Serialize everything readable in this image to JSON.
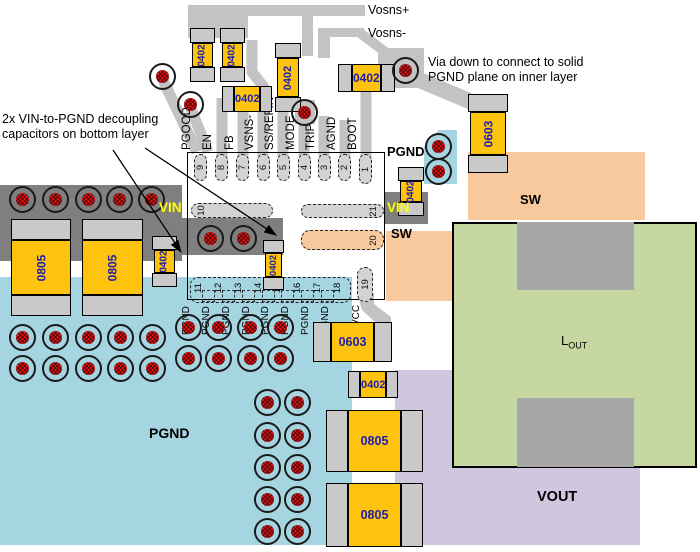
{
  "annotations": {
    "vosns_plus": "Vosns+",
    "vosns_minus": "Vosns-",
    "via_note_line1": "Via down to connect to solid",
    "via_note_line2": "PGND plane on inner layer",
    "decap_note_line1": "2x VIN-to-PGND decoupling",
    "decap_note_line2": "capacitors on bottom layer"
  },
  "planes": {
    "vin_left_label": "VIN",
    "vin_right_label": "VIN",
    "pgnd_patch_label": "PGND",
    "pgnd_main_label": "PGND",
    "sw_pin_label": "SW",
    "sw_plane_label": "SW",
    "vout_label": "VOUT",
    "lout_label_main": "L",
    "lout_label_sub": "OUT"
  },
  "ic": {
    "top_pins": [
      {
        "num": "9",
        "label": "PGOOD"
      },
      {
        "num": "8",
        "label": "EN"
      },
      {
        "num": "7",
        "label": "FB"
      },
      {
        "num": "6",
        "label": "VSNS-"
      },
      {
        "num": "5",
        "label": "SS/REFIN"
      },
      {
        "num": "4",
        "label": "MODE"
      },
      {
        "num": "3",
        "label": "TRIP"
      },
      {
        "num": "2",
        "label": "AGND"
      },
      {
        "num": "1",
        "label": "BOOT"
      }
    ],
    "bottom_pins": [
      {
        "num": "11",
        "label": "PGND"
      },
      {
        "num": "12",
        "label": "PGND"
      },
      {
        "num": "13",
        "label": "PGND"
      },
      {
        "num": "14",
        "label": "PGND"
      },
      {
        "num": "15",
        "label": "PGND"
      },
      {
        "num": "16",
        "label": "PGND"
      },
      {
        "num": "17",
        "label": "PGND"
      },
      {
        "num": "18",
        "label": "PGND"
      }
    ],
    "pin10": "10",
    "pin19": "19",
    "pin19_label": "VCC",
    "pin20": "20",
    "pin21": "21"
  },
  "components": {
    "labels": {
      "c0402": "0402",
      "c0603": "0603",
      "c0805": "0805"
    }
  }
}
